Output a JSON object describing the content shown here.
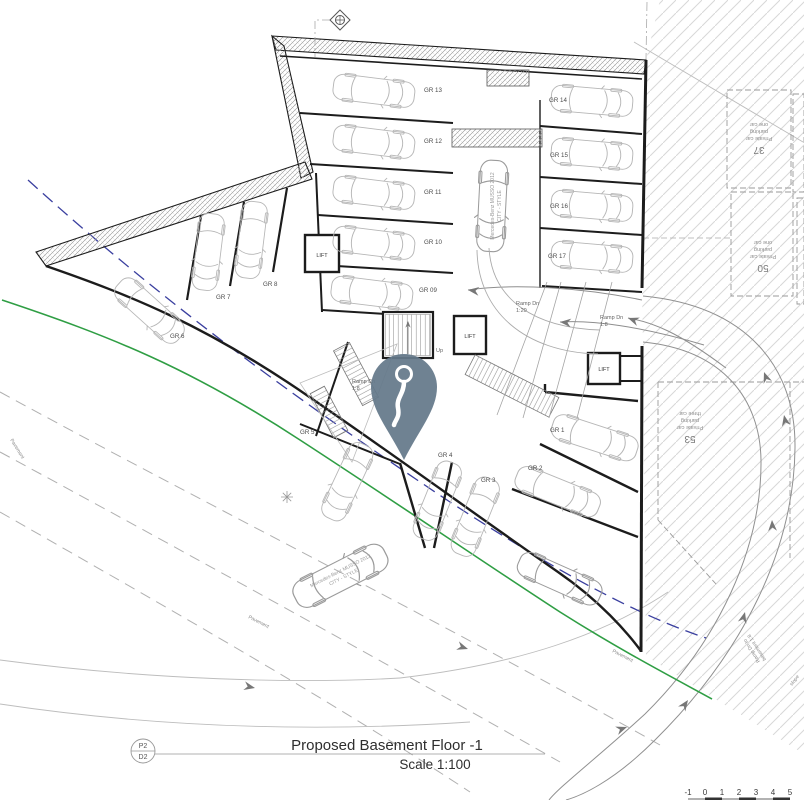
{
  "document": {
    "title": "Proposed Basement Floor -1",
    "scale": "Scale 1:100"
  },
  "revision_marker": {
    "top": "P2",
    "bottom": "D2"
  },
  "bays": {
    "b13": "GR 13",
    "b12": "GR 12",
    "b11": "GR 11",
    "b10": "GR 10",
    "b09": "GR 09",
    "b14": "GR 14",
    "b15": "GR 15",
    "b16": "GR 16",
    "b17": "GR 17",
    "b8": "GR 8",
    "b7": "GR 7",
    "b6": "GR 6",
    "b5": "GR 5",
    "b4": "GR 4",
    "b3": "GR 3",
    "b2": "GR 2",
    "b1": "GR 1"
  },
  "core": {
    "lift": "LIFT",
    "up": "Up"
  },
  "ramp": {
    "dn": "Ramp Dn",
    "r18": "1:8",
    "r120": "1:20",
    "to_basement_1": "Ramp Dn to",
    "to_basement_2": "basement 1:8",
    "slope": "slope"
  },
  "site": {
    "p37": "37",
    "p50": "50",
    "p53": "53",
    "private_car": "Private car",
    "parking": "parking",
    "one_car": "one car",
    "three_car": "three car"
  },
  "street": {
    "pavement": "Pavement"
  },
  "vehicle": {
    "make": "Mercedes-Benz MUSSO 2012",
    "trim": "CITY - STYLE"
  },
  "scalebar": [
    "-1",
    "0",
    "1",
    "2",
    "3",
    "4",
    "5"
  ],
  "colors": {
    "pin": "#64798a",
    "boundary_green": "#2f9e44",
    "boundary_blue": "#3a3f9f",
    "wall": "#1c1c1c",
    "car_outline": "#b6b6b6"
  }
}
